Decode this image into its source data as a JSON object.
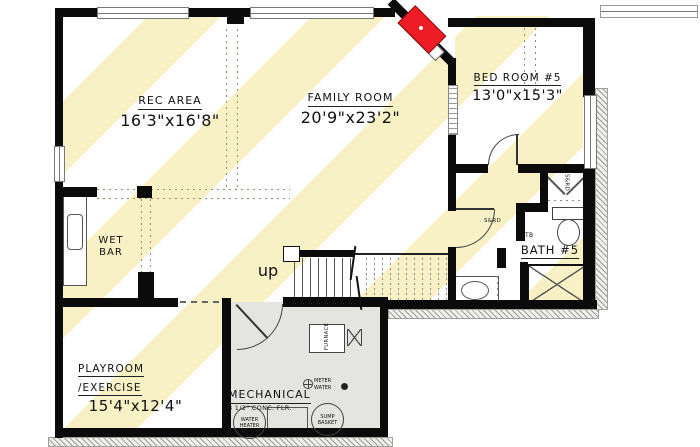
{
  "plan": {
    "rooms": {
      "rec_area": {
        "name": "REC AREA",
        "dims": "16'3\"x16'8\""
      },
      "family_room": {
        "name": "FAMILY ROOM",
        "dims": "20'9\"x23'2\""
      },
      "bedroom_5": {
        "name": "BED ROOM #5",
        "dims": "13'0\"x15'3\""
      },
      "wet_bar": {
        "line1": "WET",
        "line2": "BAR"
      },
      "bath_5": {
        "prefix": "TB",
        "name": "BATH #5"
      },
      "playroom": {
        "line1": "PLAYROOM",
        "line2": "/EXERCISE",
        "dims": "15'4\"x12'4\""
      },
      "mechanical": {
        "name": "MECHANICAL",
        "floor_note": "3 1/2\" CONC. FLR."
      }
    },
    "labels": {
      "up": "up",
      "furnace": "FURNACE",
      "water_meter_line1": "METER",
      "water_meter_line2": "WATER",
      "water_heater_line1": "WATER",
      "water_heater_line2": "HEATER",
      "sump_line1": "SUMP",
      "sump_line2": "BASKET",
      "closet_shelf_vertical": "S&RD",
      "closet_shelf_horizontal": "S&RD"
    },
    "colors": {
      "stripe_yellow": "#f7f1c5",
      "wall_black": "#0b0b0b",
      "mechanical_floor_gray": "#e4e4e1",
      "fireplace_red": "#ee1c24",
      "hatch_gray": "#9a9a9a"
    }
  }
}
